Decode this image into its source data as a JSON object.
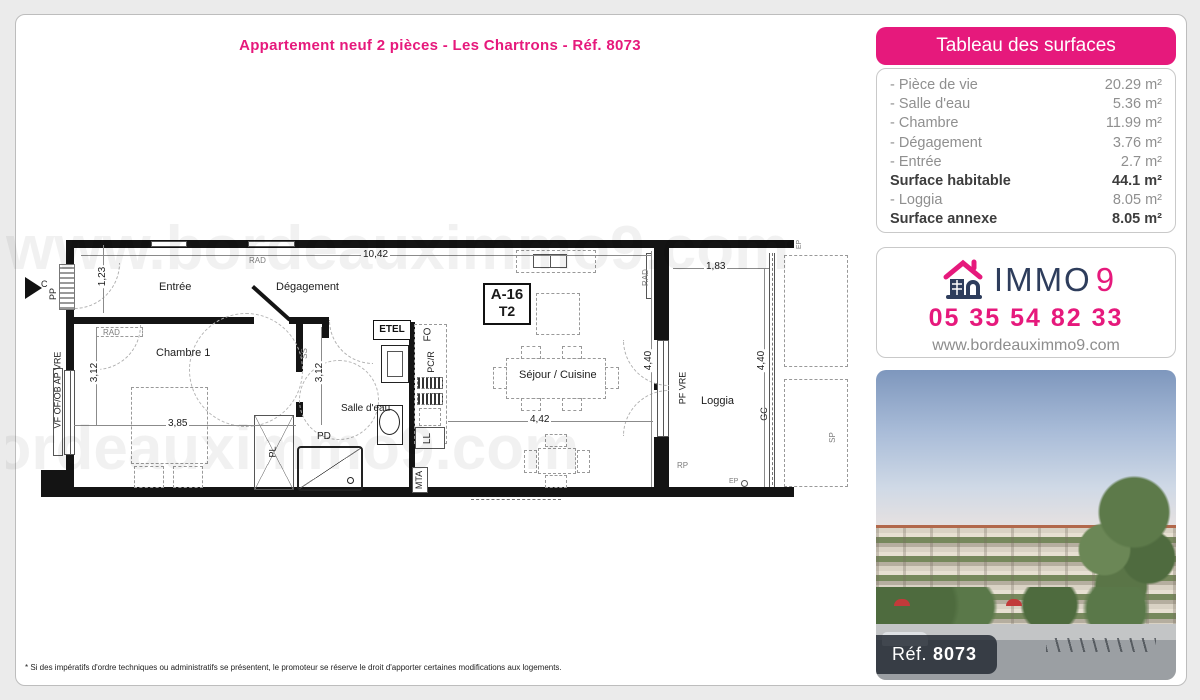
{
  "page": {
    "title": "Appartement neuf 2 pièces - Les Chartrons - Réf. 8073",
    "watermark": "www.bordeauximmo9.com",
    "disclaimer": "* Si des impératifs d'ordre techniques ou administratifs se présentent, le promoteur se réserve le droit d'apporter certaines modifications aux logements."
  },
  "surfaces_table": {
    "header": "Tableau des surfaces",
    "rows": [
      {
        "label": "- Pièce de vie",
        "value": "20.29 m²",
        "bold": false
      },
      {
        "label": "- Salle d'eau",
        "value": "5.36 m²",
        "bold": false
      },
      {
        "label": "- Chambre",
        "value": "11.99 m²",
        "bold": false
      },
      {
        "label": "- Dégagement",
        "value": "3.76 m²",
        "bold": false
      },
      {
        "label": "- Entrée",
        "value": "2.7 m²",
        "bold": false
      },
      {
        "label": "Surface habitable",
        "value": "44.1 m²",
        "bold": true
      },
      {
        "label": "- Loggia",
        "value": "8.05 m²",
        "bold": false
      },
      {
        "label": "Surface annexe",
        "value": "8.05 m²",
        "bold": true
      }
    ]
  },
  "agency": {
    "brand_immo": "IMMO",
    "brand_9": "9",
    "phone": "05 35 54 82 33",
    "website": "www.bordeauximmo9.com",
    "colors": {
      "pink": "#e6197c",
      "navy": "#2e3d5c"
    }
  },
  "photo": {
    "ref_label": "Réf.",
    "ref_number": "8073"
  },
  "plan": {
    "unit_box": {
      "line1": "A-16",
      "line2": "T2"
    },
    "rooms": {
      "entree": "Entrée",
      "degagement": "Dégagement",
      "chambre": "Chambre 1",
      "salle_eau": "Salle d'eau",
      "sejour": "Séjour / Cuisine",
      "loggia": "Loggia"
    },
    "dims": {
      "top": "10,42",
      "entree_h": "1,23",
      "chambre_h": "3,12",
      "chambre_w": "3,85",
      "sdb_h": "3,12",
      "sejour_w": "4,42",
      "sejour_h": "4,40",
      "loggia_w": "1,83",
      "loggia_h": "4,40"
    },
    "ann": {
      "pp": "PP",
      "c": "C",
      "vf": "VF OF/OB AP VRE",
      "rad": "RAD",
      "ss": "SS",
      "pl": "PL",
      "pd": "PD",
      "etel": "ETEL",
      "fo": "FO",
      "pcr": "PC/R",
      "ll": "LL",
      "mta": "MTA",
      "pf_vre": "PF VRE",
      "gc": "GC",
      "sp": "SP",
      "rp": "RP",
      "ep": "EP"
    }
  }
}
